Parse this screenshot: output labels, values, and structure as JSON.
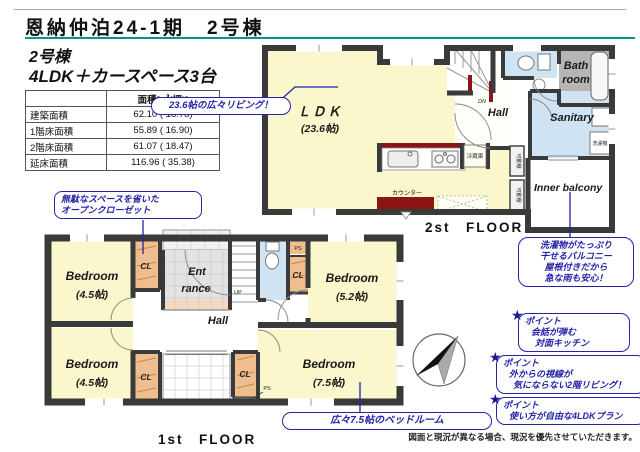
{
  "header": {
    "title": "恩納仲泊24-1期　2号棟",
    "building": "2号棟",
    "layout": "4LDK＋カースペース3台"
  },
  "area_table": {
    "header": "面積[㎡(坪)]",
    "rows": [
      {
        "label": "建築面積",
        "value": "62.10 ( 18.78)"
      },
      {
        "label": "1階床面積",
        "value": "55.89 ( 16.90)"
      },
      {
        "label": "2階床面積",
        "value": "61.07 ( 18.47)"
      },
      {
        "label": "延床面積",
        "value": "116.96 ( 35.38)"
      }
    ]
  },
  "floor2": {
    "floor_label": "2st　FLOOR",
    "ldk": "ＬＤＫ",
    "ldk_size": "(23.6帖)",
    "hall": "Hall",
    "dn": "DN",
    "bath_1": "Bath",
    "bath_2": "room",
    "sanitary": "Sanitary",
    "inner_balcony": "Inner balcony",
    "refrigerator": "冷蔵庫",
    "counter": "カウンター",
    "washer": "洗濯機",
    "shelf": "可動棚"
  },
  "floor1": {
    "floor_label": "1st　FLOOR",
    "bedroom": "Bedroom",
    "bedroom_tl_size": "(4.5帖)",
    "bedroom_bl_size": "(4.5帖)",
    "bedroom_tr_size": "(5.2帖)",
    "bedroom_br_size": "(7.5帖)",
    "hall": "Hall",
    "ent_1": "Ent",
    "ent_2": "rance",
    "cl": "CL",
    "ps": "PS",
    "up": "UP"
  },
  "callouts": {
    "living": "23.6帖の広々リビング！",
    "closet_1": "無駄なスペースを省いた",
    "closet_2": "オープンクローゼット",
    "balcony_1": "洗濯物がたっぷり",
    "balcony_2": "干せるバルコニー",
    "balcony_3": "屋根付きだから",
    "balcony_4": "急な雨も安心！",
    "point_label": "ポイント",
    "kitchen_1": "会話が弾む",
    "kitchen_2": "対面キッチン",
    "living2f_1": "外からの視線が",
    "living2f_2": "気にならない2階リビング！",
    "plan_1": "使い方が自由な4LDKプラン",
    "bedroom75": "広々7.5帖のベッドルーム"
  },
  "footer": {
    "disclaimer": "図面と現況が異なる場合、現況を優先させていただきます。"
  },
  "colors": {
    "accent_blue": "#2323a8",
    "wall": "#3a3a3a",
    "room_yellow": "#faf7cd",
    "closet_orange": "#f0bd8e",
    "water_blue": "#cfe3f2",
    "bath_gray": "#b5b5b5",
    "kitchen_red": "#8b1414",
    "underline_teal": "#009688"
  }
}
